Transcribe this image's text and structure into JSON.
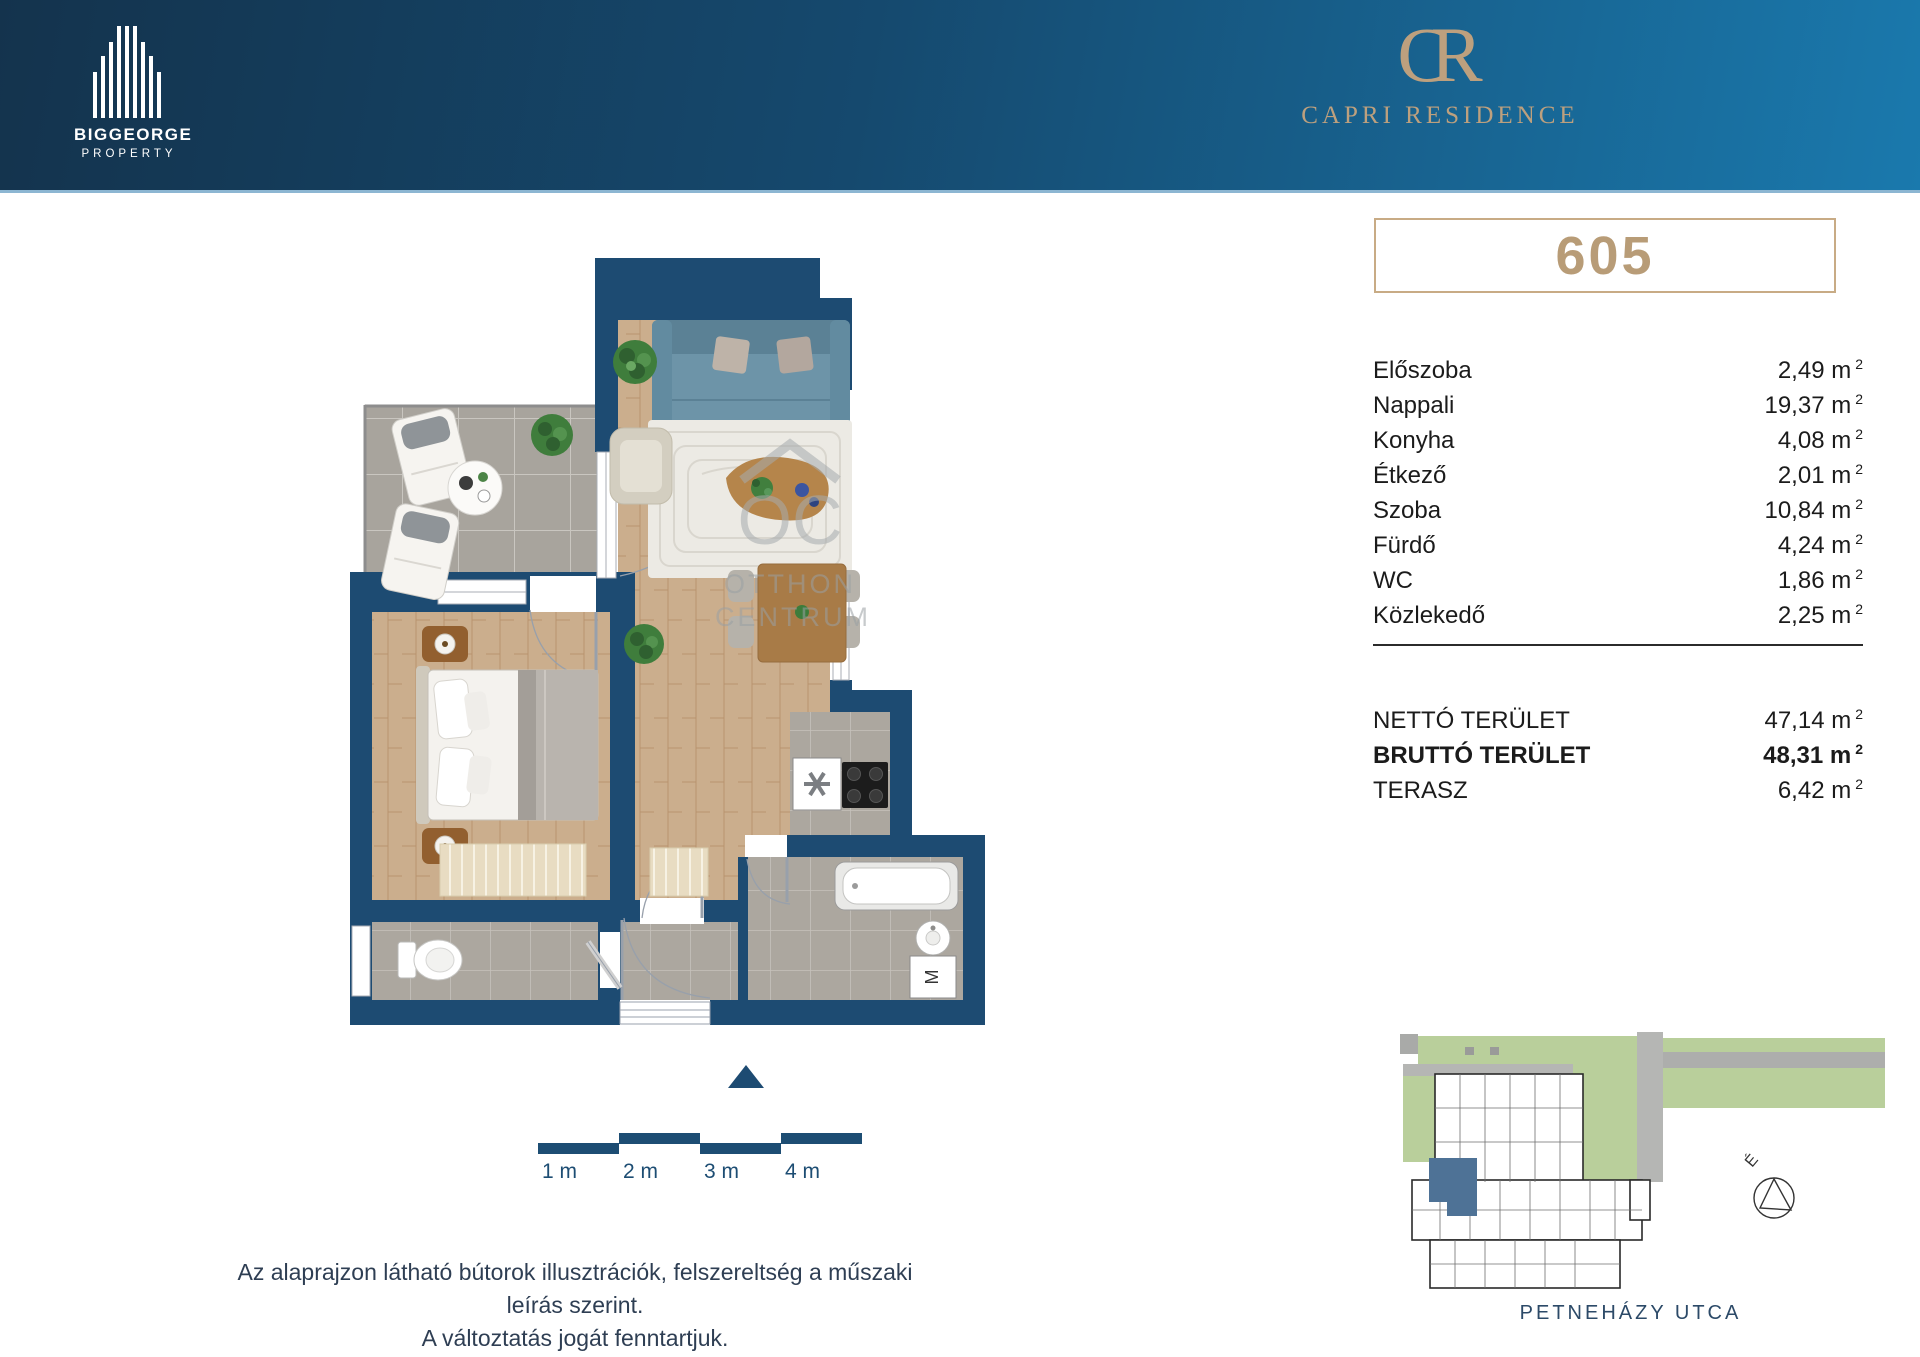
{
  "header": {
    "brand_top": "BIGGEORGE",
    "brand_sub": "PROPERTY",
    "project_monogram_c": "C",
    "project_monogram_r": "R",
    "project_name": "CAPRI RESIDENCE"
  },
  "unit": {
    "number": "605"
  },
  "area_unit": {
    "label": "m",
    "sup": "2"
  },
  "rooms": [
    {
      "label": "Előszoba",
      "area": "2,49"
    },
    {
      "label": "Nappali",
      "area": "19,37"
    },
    {
      "label": "Konyha",
      "area": "4,08"
    },
    {
      "label": "Étkező",
      "area": "2,01"
    },
    {
      "label": "Szoba",
      "area": "10,84"
    },
    {
      "label": "Fürdő",
      "area": "4,24"
    },
    {
      "label": "WC",
      "area": "1,86"
    },
    {
      "label": "Közlekedő",
      "area": "2,25"
    }
  ],
  "totals": [
    {
      "label": "NETTÓ TERÜLET",
      "area": "47,14",
      "bold": false
    },
    {
      "label": "BRUTTÓ TERÜLET",
      "area": "48,31",
      "bold": true
    },
    {
      "label": "TERASZ",
      "area": "6,42",
      "bold": false
    }
  ],
  "scalebar": {
    "labels": [
      "1 m",
      "2 m",
      "3 m",
      "4 m"
    ]
  },
  "watermark": {
    "monogram": "OC",
    "line1": "OTTHON",
    "line2": "CENTRUM"
  },
  "site": {
    "street": "PETNEHÁZY UTCA",
    "north_label": "É"
  },
  "footer": {
    "line1": "Az alaprajzon látható bútorok illusztrációk, felszereltség a műszaki leírás szerint.",
    "line2": "A változtatás jogát fenntartjuk."
  },
  "colors": {
    "banner-start": "#14334d",
    "banner-mid": "#15496e",
    "banner-end": "#1a79ad",
    "navy": "#1d4b72",
    "gold": "#bda07e",
    "ink": "#1b1b1b",
    "footer-ink": "#2e3e53",
    "scale-navy": "#1d4d73",
    "street-ink": "#2c4a68",
    "wood": "#cbae8d",
    "tile": "#ada89f",
    "sofa-teal": "#6d94a8",
    "site-green": "#b9cf9b",
    "highlight-unit": "#4e7296"
  }
}
